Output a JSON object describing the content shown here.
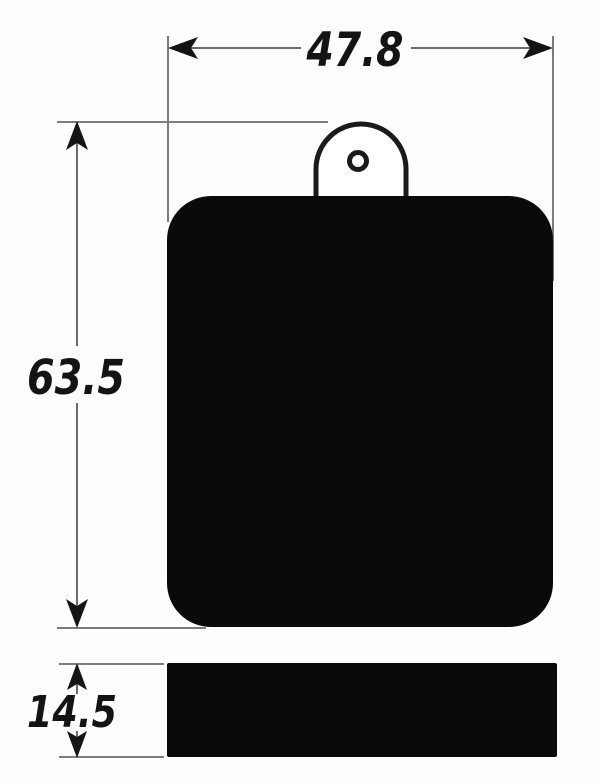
{
  "drawing": {
    "dimensions": {
      "width": "47.8",
      "height": "63.5",
      "thickness": "14.5"
    },
    "colors": {
      "ink": "#141414",
      "thin_line": "#7d7d7d",
      "part_fill": "#0a0a0a",
      "background": "#fdfdfd"
    }
  }
}
